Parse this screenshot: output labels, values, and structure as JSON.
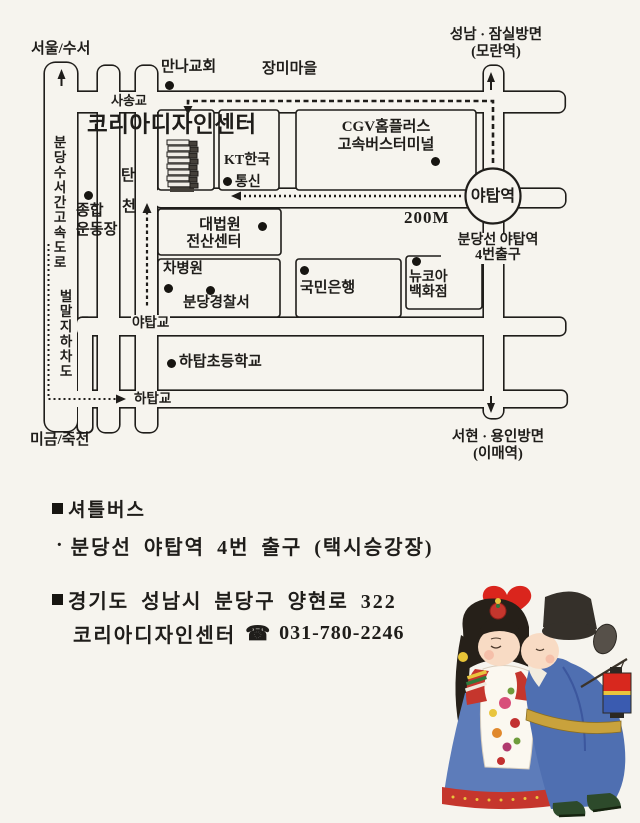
{
  "colors": {
    "paper": "#f6f4ee",
    "ink": "#1f1d1a",
    "heart": "#da251d",
    "robe_blue": "#4f6fb1",
    "skirt_blue": "#5d7cba",
    "hem_red": "#c5362d",
    "lantern_red": "#d8281e",
    "lantern_blue": "#3a5bb0",
    "belt_gold": "#c9a23c"
  },
  "map": {
    "directions": {
      "top_left": "서울/수서",
      "bottom_left": "미금/죽전",
      "top_right_line1": "성남 · 잠실방면",
      "top_right_line2": "(모란역)",
      "bottom_right_line1": "서현 · 용인방면",
      "bottom_right_line2": "(이매역)"
    },
    "roads": {
      "expressway": "분당수서간고속도로",
      "underpass": "벌말지하차도",
      "stream_char1": "탄",
      "stream_char2": "천",
      "bridge_sasong": "사송교",
      "bridge_yatap": "야탑교",
      "bridge_hatap": "하탑교"
    },
    "places": {
      "church": "만나교회",
      "village": "장미마을",
      "design_center": "코리아디자인센터",
      "kt_line1": "KT한국",
      "kt_line2": "통신",
      "cgv_line1": "CGV홈플러스",
      "cgv_line2": "고속버스터미널",
      "court_line1": "대법원",
      "court_line2": "전산센터",
      "hospital": "차병원",
      "police": "분당경찰서",
      "bank": "국민은행",
      "dept_line1": "뉴코아",
      "dept_line2": "백화점",
      "school": "하탑초등학교",
      "sports_line1": "종합",
      "sports_line2": "운동장",
      "station": "야탑역",
      "distance": "200M",
      "exit_line1": "분당선 야탑역",
      "exit_line2": "4번출구"
    }
  },
  "info": {
    "bullet": "■",
    "item_marker": "·",
    "shuttle_title": "셔틀버스",
    "shuttle_item": "분당선 야탑역 4번 출구 (택시승강장)",
    "address": "경기도 성남시 분당구 양현로 322",
    "center_name": "코리아디자인센터",
    "phone_icon": "☎",
    "phone": "031-780-2246"
  }
}
